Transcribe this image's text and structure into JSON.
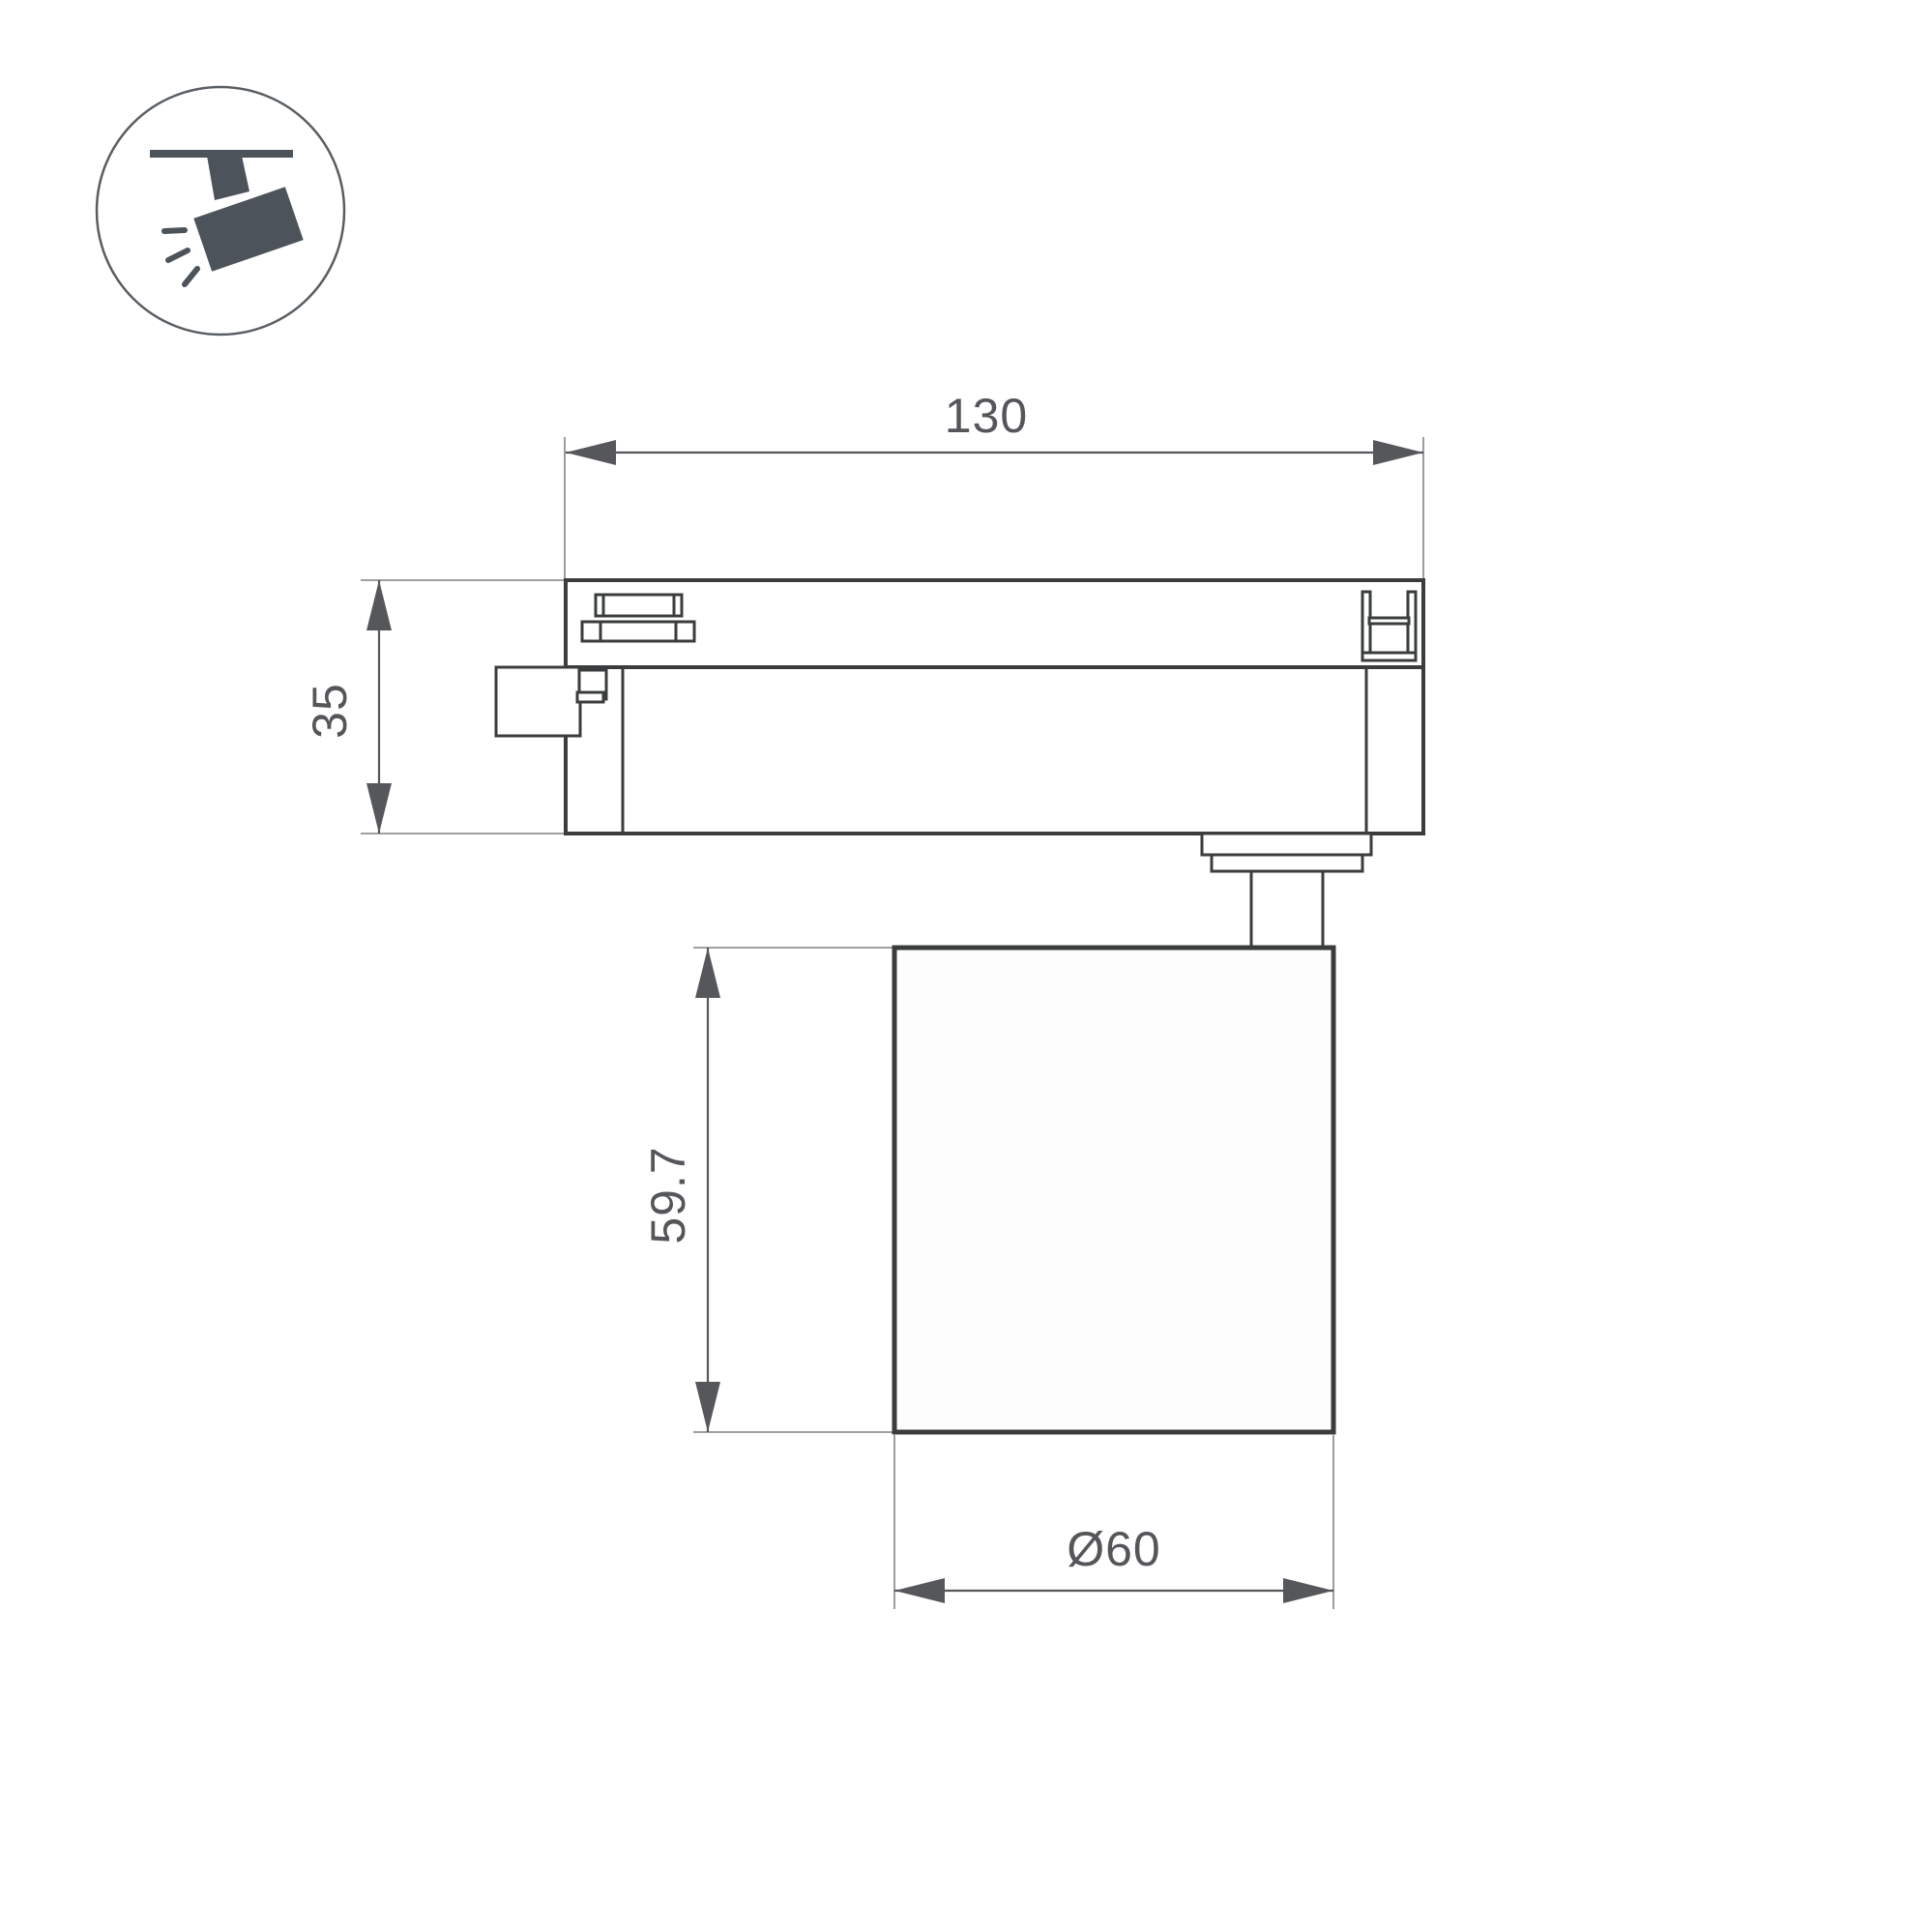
{
  "drawing": {
    "dimension_labels": {
      "track_width": "130",
      "track_height": "35",
      "lamp_height": "59.7",
      "lamp_diameter": "Ø60"
    },
    "dimensions_mm": {
      "track_width": 130,
      "track_height": 35,
      "lamp_height": 59.7,
      "lamp_diameter": 60
    },
    "icon": "track-spotlight",
    "colors": {
      "outline": "#3a3c3e",
      "dimension": "#55575a",
      "extension": "#909296",
      "text": "#54565a",
      "icon_fill": "#4d535a",
      "lamp_fill": "#fdfdfe",
      "background": "#ffffff"
    }
  }
}
